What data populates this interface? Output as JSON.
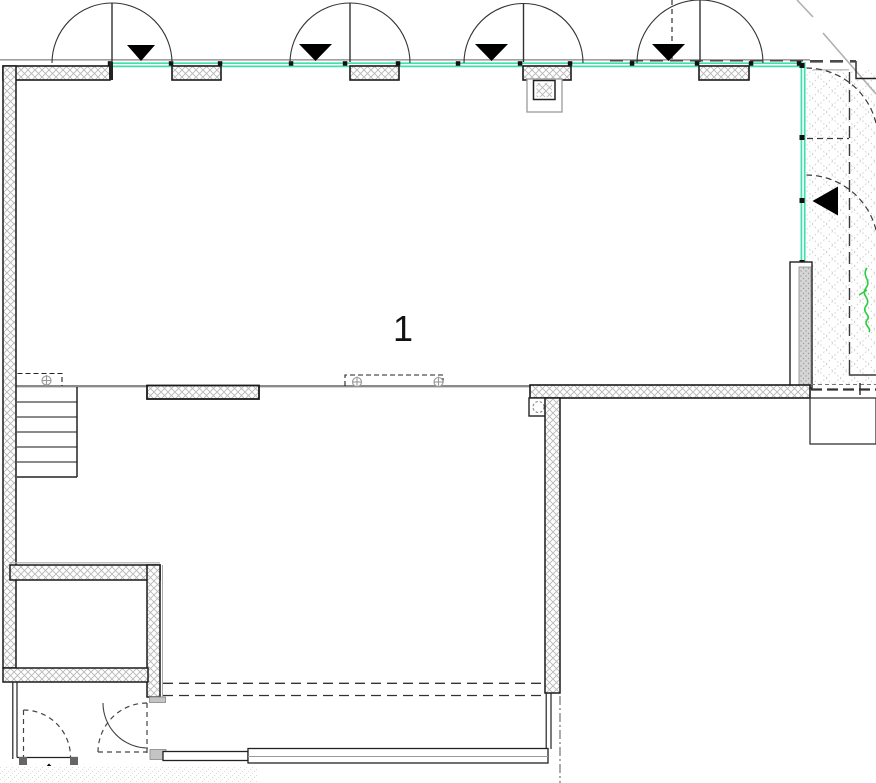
{
  "meta": {
    "type": "architectural-floor-plan",
    "view": "plan"
  },
  "room": {
    "label": "1"
  },
  "colors": {
    "glazing": "#3fdfae",
    "vegetation": "#2ecc40",
    "wall_line": "#1a1a1a",
    "gray_line": "#8a8a8a",
    "hatch": "#b8b8b8",
    "dash": "#3a3a3a"
  },
  "icons": {
    "door_swing_arrow": "black triangle",
    "entry_arrow": "black triangle",
    "fixture_symbol": "circle-cross"
  },
  "counts": {
    "top_entrance_doors": 4,
    "down_swing_arrows": 4,
    "left_swing_arrows": 1,
    "up_entry_arrows": 1,
    "stair_treads": 6,
    "glazing_mullions_top": 13,
    "glazing_mullions_right": 4,
    "dashed_vestibule_doors": 2
  }
}
